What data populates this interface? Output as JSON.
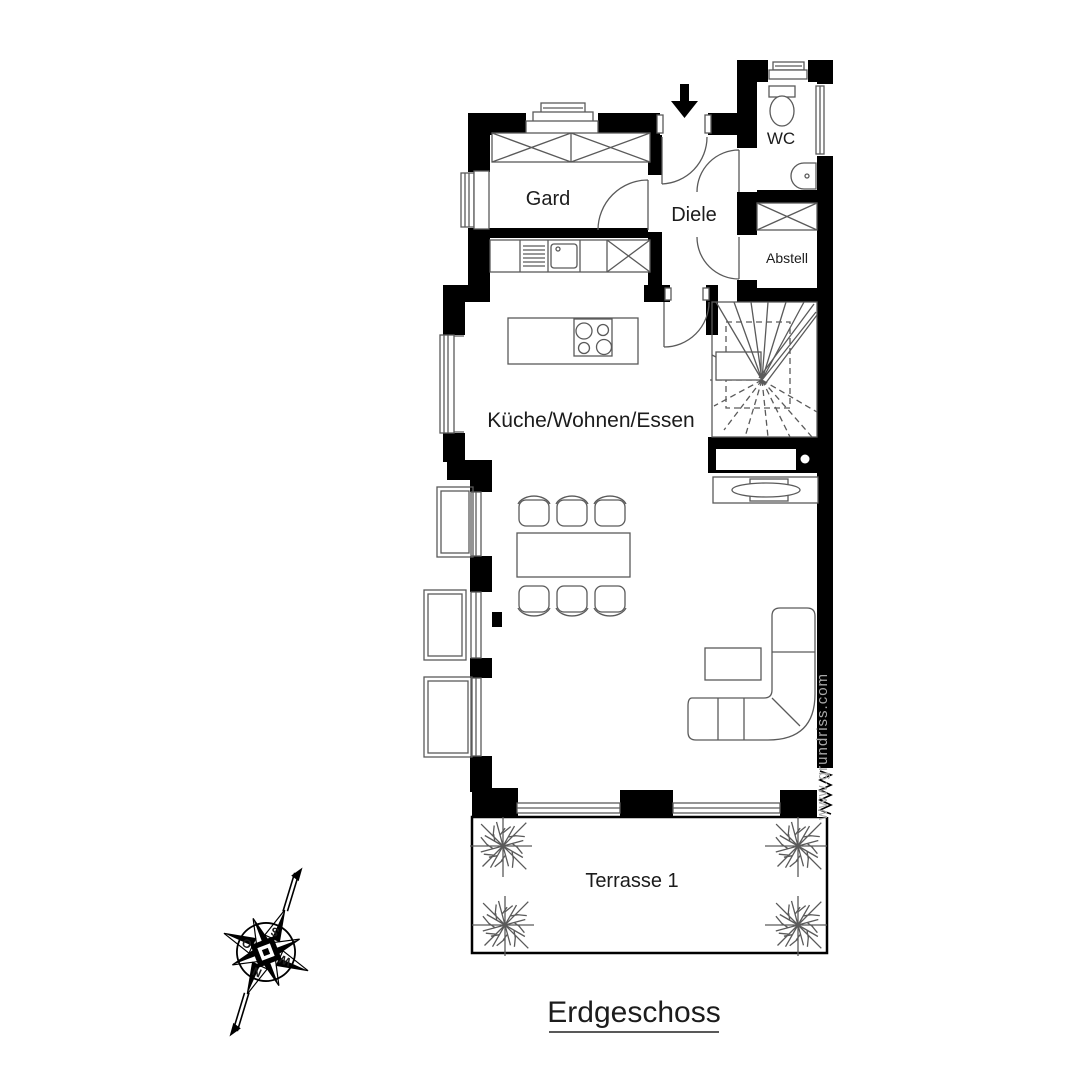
{
  "page": {
    "title": "Erdgeschoss"
  },
  "watermark": "www.grundriss.com",
  "rooms": {
    "gard": "Gard",
    "diele": "Diele",
    "wc": "WC",
    "abstell": "Abstell",
    "living": "Küche/Wohnen/Essen",
    "terrace": "Terrasse 1"
  },
  "compass": {
    "north": "N",
    "east": "O",
    "south": "S",
    "west": "W"
  },
  "colors": {
    "wall": "#000000",
    "furniture_line": "#5a5a5a",
    "text": "#1c1c1c",
    "watermark": "#a8a8a8",
    "background": "#ffffff"
  }
}
